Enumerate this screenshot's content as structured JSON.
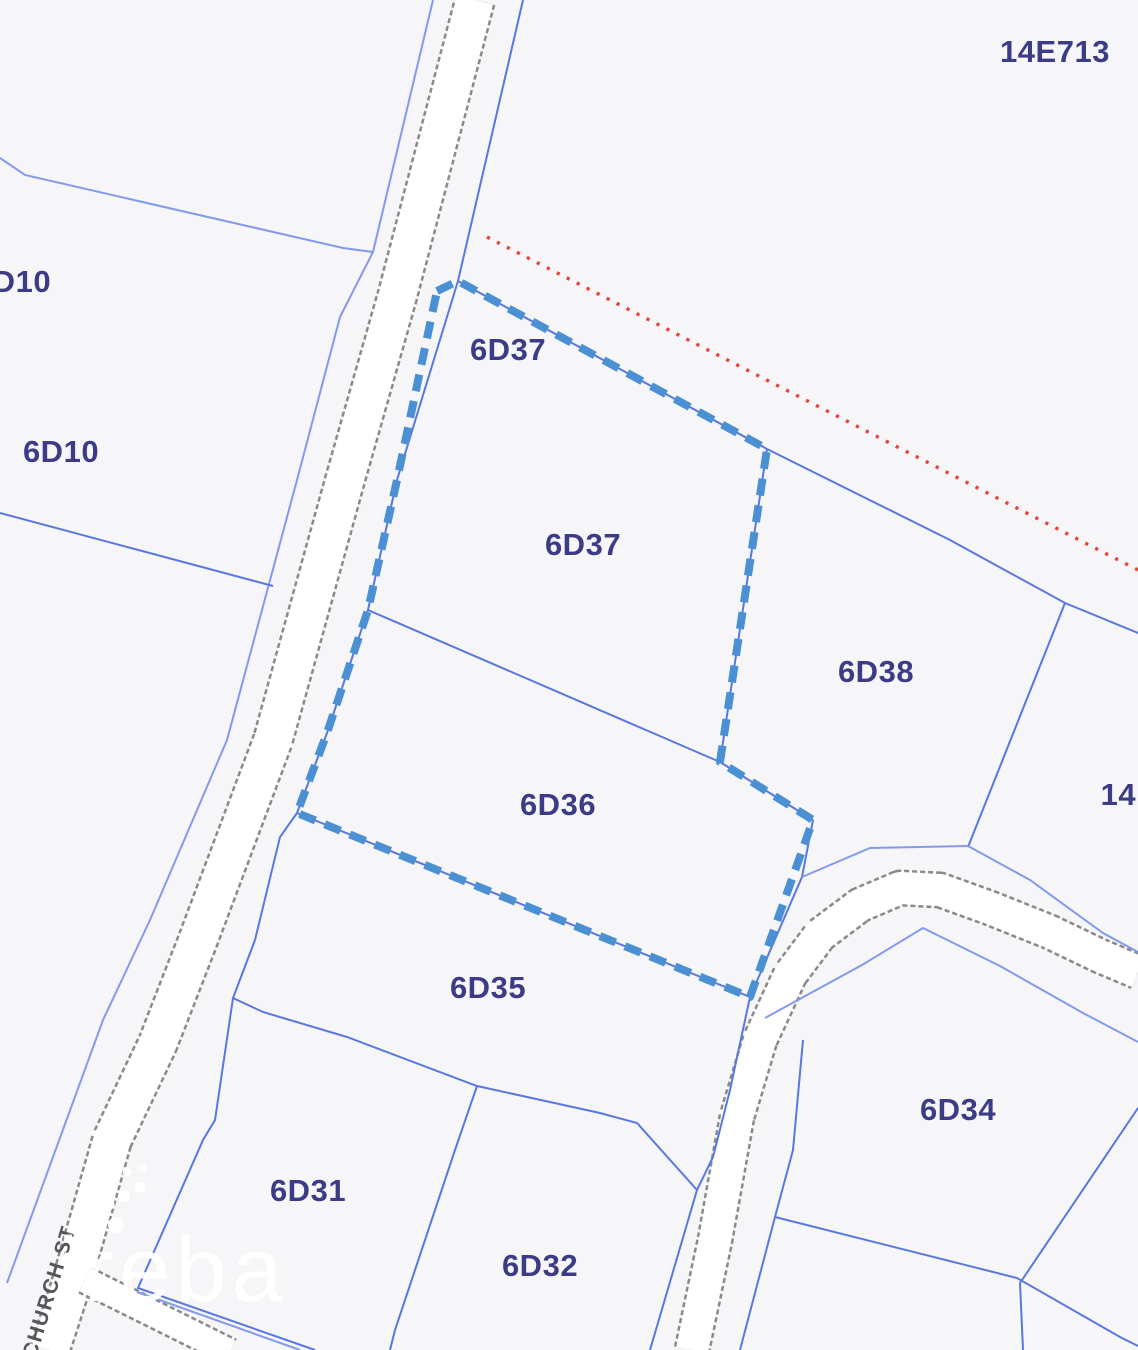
{
  "map": {
    "colors": {
      "background": "#f6f6f8",
      "parcel_line": "#5977e0",
      "parcel_line_light": "#839aec",
      "selection_dashed": "#4a90d2",
      "red_dotted_boundary": "#e8423c",
      "road_casing": "#8a8a8a",
      "road_fill": "#ffffff",
      "parcel_label": "#3c3c86"
    },
    "labels": {
      "parcel_14e713": "14E713",
      "parcel_6d10_partial": "6D10",
      "parcel_6d10": "6D10",
      "parcel_6d37_upper": "6D37",
      "parcel_6d37": "6D37",
      "parcel_6d38": "6D38",
      "parcel_6d36": "6D36",
      "parcel_14e_partial": "14E",
      "parcel_6d35": "6D35",
      "parcel_6d34": "6D34",
      "parcel_6d31": "6D31",
      "parcel_6d32": "6D32"
    },
    "street": {
      "name": "CHURCH ST"
    },
    "watermark": {
      "text": "ireba"
    }
  }
}
